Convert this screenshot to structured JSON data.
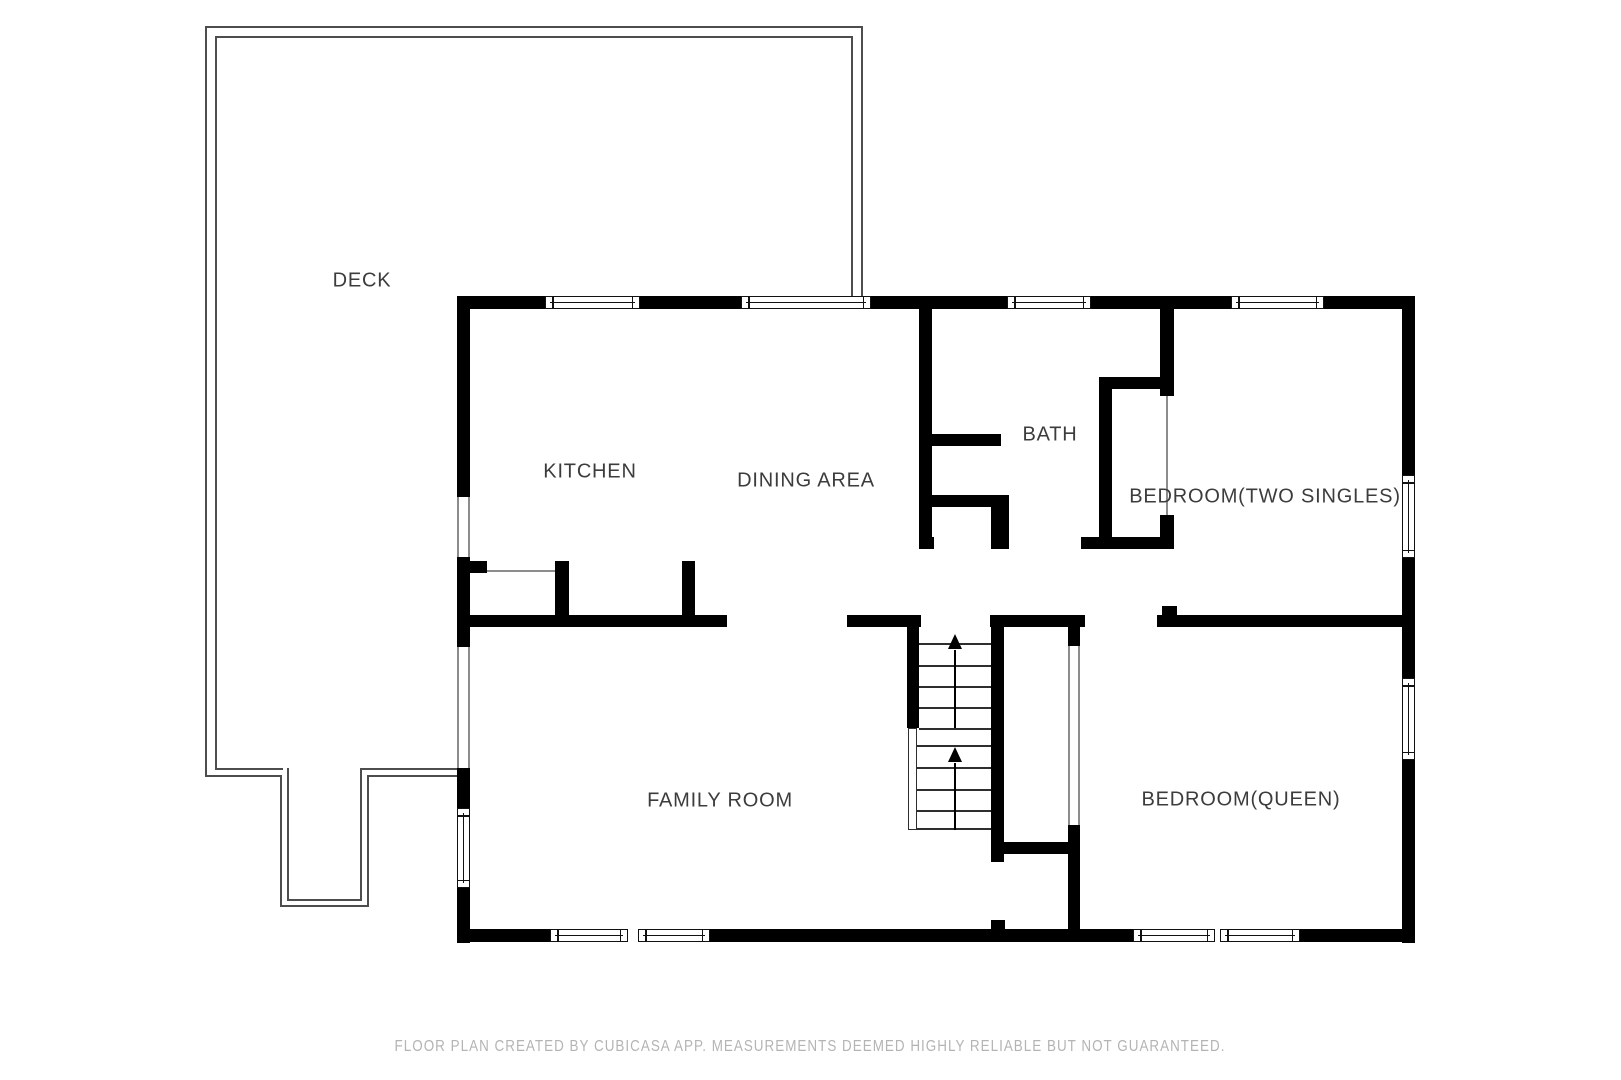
{
  "footer": "FLOOR PLAN CREATED BY CUBICASA APP. MEASUREMENTS DEEMED HIGHLY RELIABLE BUT NOT GUARANTEED.",
  "colors": {
    "wall": "#000000",
    "deck_outline": "#4d4d4d",
    "opening_line": "#8c8c8c",
    "label_text": "#3c3c3c",
    "footer_text": "#b4b4b4",
    "background": "#ffffff"
  },
  "rooms": [
    {
      "id": "deck",
      "label": "DECK",
      "cx": 362,
      "cy": 281
    },
    {
      "id": "kitchen",
      "label": "KITCHEN",
      "cx": 590,
      "cy": 472
    },
    {
      "id": "dining-area",
      "label": "DINING AREA",
      "cx": 806,
      "cy": 481
    },
    {
      "id": "bath",
      "label": "BATH",
      "cx": 1050,
      "cy": 435
    },
    {
      "id": "bedroom-two-singles",
      "label": "BEDROOM(TWO SINGLES)",
      "cx": 1265,
      "cy": 497
    },
    {
      "id": "family-room",
      "label": "FAMILY ROOM",
      "cx": 720,
      "cy": 801
    },
    {
      "id": "bedroom-queen",
      "label": "BEDROOM(QUEEN)",
      "cx": 1241,
      "cy": 800
    }
  ],
  "walls": [
    [
      457,
      296,
      88,
      13
    ],
    [
      640,
      296,
      101,
      13
    ],
    [
      871,
      296,
      136,
      13
    ],
    [
      1091,
      296,
      140,
      13
    ],
    [
      1324,
      296,
      91,
      13
    ],
    [
      457,
      296,
      13,
      201
    ],
    [
      457,
      557,
      13,
      90
    ],
    [
      457,
      768,
      13,
      40
    ],
    [
      457,
      888,
      13,
      55
    ],
    [
      1402,
      296,
      13,
      179
    ],
    [
      1402,
      558,
      13,
      120
    ],
    [
      1402,
      760,
      13,
      183
    ],
    [
      457,
      929,
      93,
      13
    ],
    [
      710,
      929,
      423,
      13
    ],
    [
      1300,
      929,
      115,
      13
    ],
    [
      919,
      309,
      13,
      240
    ],
    [
      919,
      434,
      82,
      12
    ],
    [
      919,
      495,
      82,
      12
    ],
    [
      991,
      495,
      18,
      54
    ],
    [
      919,
      537,
      15,
      12
    ],
    [
      1081,
      537,
      93,
      12
    ],
    [
      1099,
      377,
      13,
      172
    ],
    [
      1099,
      377,
      75,
      12
    ],
    [
      1160,
      309,
      14,
      87
    ],
    [
      1160,
      515,
      14,
      34
    ],
    [
      460,
      615,
      267,
      12
    ],
    [
      847,
      615,
      74,
      12
    ],
    [
      990,
      615,
      95,
      12
    ],
    [
      1157,
      615,
      258,
      12
    ],
    [
      1162,
      606,
      15,
      9
    ],
    [
      470,
      561,
      17,
      12
    ],
    [
      555,
      561,
      14,
      66
    ],
    [
      682,
      561,
      13,
      66
    ],
    [
      907,
      627,
      12,
      101
    ],
    [
      991,
      615,
      13,
      247
    ],
    [
      1002,
      842,
      71,
      12
    ],
    [
      1068,
      825,
      12,
      117
    ],
    [
      1068,
      627,
      12,
      19
    ],
    [
      991,
      920,
      14,
      10
    ]
  ],
  "windows": [
    {
      "r": [
        545,
        296,
        95,
        13
      ],
      "o": "h"
    },
    {
      "r": [
        741,
        296,
        130,
        13
      ],
      "o": "h"
    },
    {
      "r": [
        1007,
        296,
        84,
        13
      ],
      "o": "h"
    },
    {
      "r": [
        1231,
        296,
        93,
        13
      ],
      "o": "h"
    },
    {
      "r": [
        457,
        808,
        13,
        80
      ],
      "o": "v"
    },
    {
      "r": [
        1402,
        475,
        13,
        83
      ],
      "o": "v"
    },
    {
      "r": [
        1402,
        678,
        13,
        82
      ],
      "o": "v"
    },
    {
      "r": [
        550,
        929,
        78,
        13
      ],
      "o": "h"
    },
    {
      "r": [
        638,
        929,
        72,
        13
      ],
      "o": "h"
    },
    {
      "r": [
        1133,
        929,
        82,
        13
      ],
      "o": "h"
    },
    {
      "r": [
        1220,
        929,
        80,
        13
      ],
      "o": "h"
    }
  ],
  "deck_lines": [
    [
      205,
      26,
      658,
      2
    ],
    [
      861,
      26,
      2,
      272
    ],
    [
      205,
      26,
      2,
      751
    ],
    [
      205,
      775,
      77,
      2
    ],
    [
      280,
      775,
      2,
      132
    ],
    [
      280,
      905,
      89,
      2
    ],
    [
      367,
      775,
      2,
      132
    ],
    [
      367,
      775,
      92,
      2
    ],
    [
      215,
      36,
      638,
      2
    ],
    [
      851,
      36,
      2,
      262
    ],
    [
      215,
      36,
      2,
      734
    ],
    [
      215,
      768,
      68,
      2
    ],
    [
      287,
      768,
      2,
      133
    ],
    [
      287,
      899,
      75,
      2
    ],
    [
      360,
      768,
      2,
      133
    ],
    [
      360,
      768,
      99,
      2
    ]
  ],
  "thin_lines": [
    [
      487,
      570,
      68,
      2
    ],
    [
      1166,
      396,
      2,
      119
    ],
    [
      1068,
      646,
      2,
      179
    ],
    [
      1078,
      646,
      2,
      179
    ],
    [
      457,
      497,
      2,
      60
    ],
    [
      468,
      497,
      2,
      60
    ],
    [
      457,
      647,
      2,
      121
    ],
    [
      468,
      647,
      2,
      121
    ]
  ],
  "railing": [
    908,
    728,
    9,
    102
  ],
  "stairs": {
    "upper_treads": {
      "x": 919,
      "w": 72,
      "ys": [
        643,
        665,
        686,
        707,
        728
      ]
    },
    "lower_treads": {
      "x": 917,
      "w": 74,
      "ys": [
        745,
        767,
        789,
        810,
        828
      ]
    },
    "arrows": [
      {
        "cx": 955,
        "tip": 634,
        "stem_top": 650,
        "stem_bottom": 728
      },
      {
        "cx": 955,
        "tip": 747,
        "stem_top": 763,
        "stem_bottom": 830
      }
    ]
  }
}
